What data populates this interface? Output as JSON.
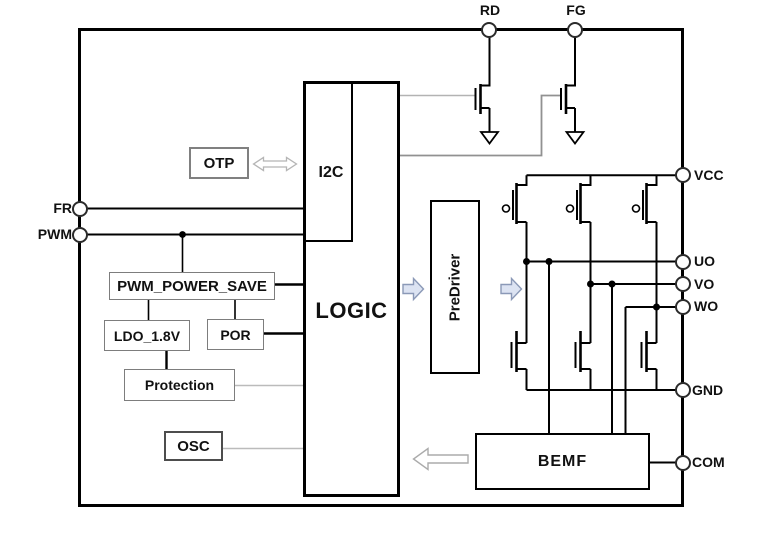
{
  "blocks": {
    "otp": "OTP",
    "i2c": "I2C",
    "logic": "LOGIC",
    "pwm_power_save": "PWM_POWER_SAVE",
    "ldo": "LDO_1.8V",
    "por": "POR",
    "protection": "Protection",
    "osc": "OSC",
    "predriver": "PreDriver",
    "bemf": "BEMF"
  },
  "pins": {
    "fr": "FR",
    "pwm": "PWM",
    "rd": "RD",
    "fg": "FG",
    "vcc": "VCC",
    "uo": "UO",
    "vo": "VO",
    "wo": "WO",
    "gnd": "GND",
    "com": "COM"
  },
  "arrows": [
    {
      "name": "otp-i2c",
      "direction": "bidirectional",
      "style": "white-outline"
    },
    {
      "name": "logic-to-predriver",
      "direction": "right",
      "style": "blue"
    },
    {
      "name": "predriver-to-bridge",
      "direction": "right",
      "style": "blue"
    },
    {
      "name": "bemf-to-logic",
      "direction": "left",
      "style": "white-outline"
    }
  ],
  "colors": {
    "wire": "#000000",
    "gate_wire_gray": "#9a9a9a",
    "connector_gray": "#bbbbbb",
    "blue_arrow_fill": "#dce3f2",
    "blue_arrow_stroke": "#8b99b7",
    "white_arrow_fill": "#ffffff",
    "white_arrow_stroke": "#ababab",
    "small_box_border": "#7d7d7d",
    "block_border": "#000000"
  }
}
